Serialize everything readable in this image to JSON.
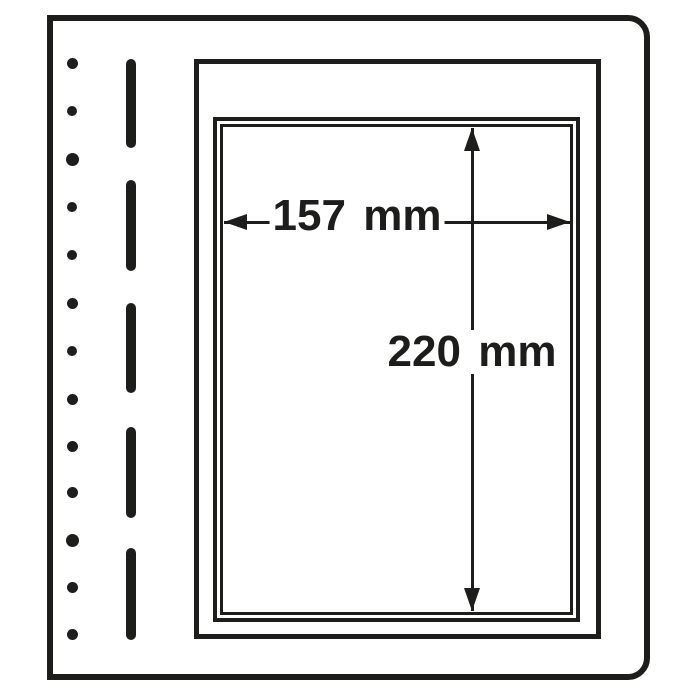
{
  "diagram": {
    "kind": "blank-album-page-dimension-diagram",
    "colors": {
      "ink": "#1d1d1b",
      "paper": "#ffffff"
    },
    "dimensions": {
      "width_label": "157 mm",
      "height_label": "220 mm"
    },
    "binder_holes": {
      "count": 13,
      "center_x": 72,
      "ys": [
        63,
        111,
        159,
        207,
        255,
        303,
        351,
        399,
        446,
        492,
        540,
        587,
        634
      ],
      "diameters": [
        11,
        10,
        13,
        10,
        10,
        11,
        10,
        11,
        11,
        11,
        13,
        11,
        11
      ]
    },
    "perforation_dashes": {
      "count": 5,
      "center_x": 131,
      "width": 10,
      "segments_y": [
        [
          59,
          148
        ],
        [
          180,
          271
        ],
        [
          303,
          393
        ],
        [
          427,
          518
        ],
        [
          548,
          640
        ]
      ]
    }
  }
}
